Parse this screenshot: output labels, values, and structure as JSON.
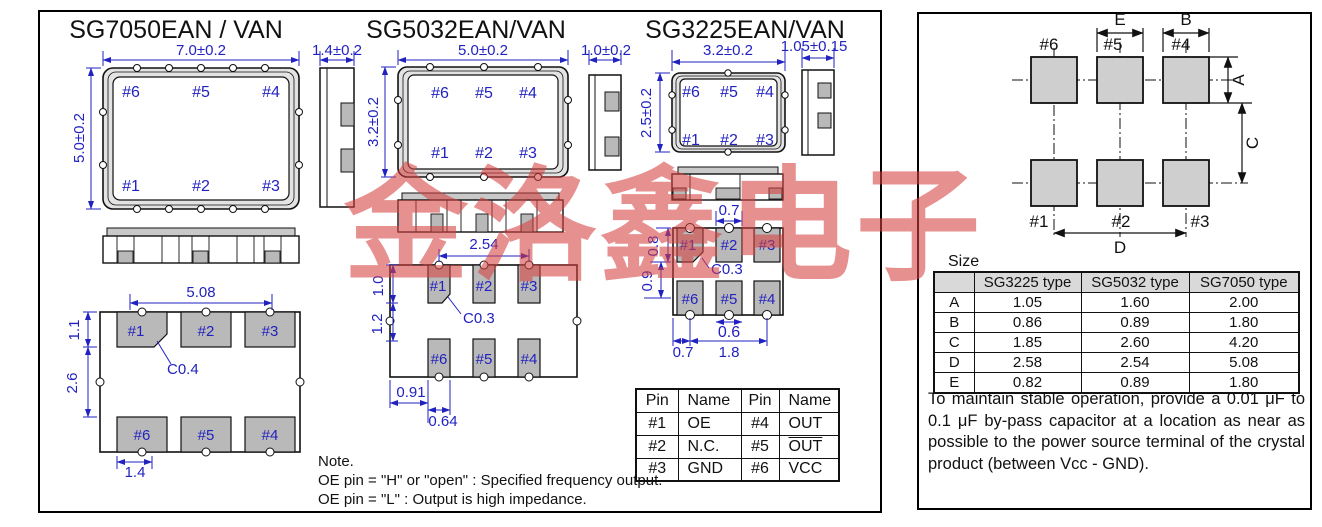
{
  "watermark": "金洛鑫电子",
  "packages": [
    {
      "title": "SG7050EAN / VAN",
      "dim_width": "7.0±0.2",
      "dim_height": "5.0±0.2",
      "dim_thickness": "1.4±0.2",
      "pins_top": [
        "#6",
        "#5",
        "#4"
      ],
      "pins_bottom": [
        "#1",
        "#2",
        "#3"
      ],
      "land": {
        "pitch": "5.08",
        "left_upper": "1.1",
        "left_lower": "2.6",
        "pad_width": "1.4",
        "chamfer": "C0.4",
        "pads_top": [
          "#1",
          "#2",
          "#3"
        ],
        "pads_bottom": [
          "#6",
          "#5",
          "#4"
        ]
      }
    },
    {
      "title": "SG5032EAN/VAN",
      "dim_width": "5.0±0.2",
      "dim_height": "3.2±0.2",
      "dim_thickness": "1.0±0.2",
      "pins_top": [
        "#6",
        "#5",
        "#4"
      ],
      "pins_bottom": [
        "#1",
        "#2",
        "#3"
      ],
      "land": {
        "pitch": "2.54",
        "left_upper": "1.0",
        "left_lower": "1.2",
        "offset": "0.91",
        "pad_width": "0.64",
        "chamfer": "C0.3",
        "pads_top": [
          "#1",
          "#2",
          "#3"
        ],
        "pads_bottom": [
          "#6",
          "#5",
          "#4"
        ]
      }
    },
    {
      "title": "SG3225EAN/VAN",
      "dim_width": "3.2±0.2",
      "dim_height": "2.5±0.2",
      "dim_thickness": "1.05±0.15",
      "pins_top": [
        "#6",
        "#5",
        "#4"
      ],
      "pins_bottom": [
        "#1",
        "#2",
        "#3"
      ],
      "land": {
        "top": "0.7",
        "left_upper": "0.8",
        "left_lower": "0.9",
        "notch": "0.6",
        "bottom_left": "0.7",
        "bottom_right": "1.8",
        "chamfer": "C0.3",
        "pads_top": [
          "#1",
          "#2",
          "#3"
        ],
        "pads_bottom": [
          "#6",
          "#5",
          "#4"
        ]
      }
    }
  ],
  "pin_table": {
    "headers": [
      "Pin",
      "Name",
      "Pin",
      "Name"
    ],
    "rows": [
      [
        "#1",
        "OE",
        "#4",
        "OUT"
      ],
      [
        "#2",
        "N.C.",
        "#5",
        "OUT"
      ],
      [
        "#3",
        "GND",
        "#6",
        "VCC"
      ]
    ]
  },
  "note": {
    "title": "Note.",
    "line1": "OE pin = \"H\" or \"open\" : Specified frequency output.",
    "line2": "OE pin = \"L\" : Output is high impedance."
  },
  "pad_layout": {
    "pins_top": [
      "#6",
      "#5",
      "#4"
    ],
    "pins_bottom": [
      "#1",
      "#2",
      "#3"
    ],
    "dim_e": "E",
    "dim_b": "B",
    "dim_a": "A",
    "dim_c": "C",
    "dim_d": "D"
  },
  "size_table": {
    "caption": "Size",
    "headers": [
      "",
      "SG3225 type",
      "SG5032 type",
      "SG7050 type"
    ],
    "rows": [
      [
        "A",
        "1.05",
        "1.60",
        "2.00"
      ],
      [
        "B",
        "0.86",
        "0.89",
        "1.80"
      ],
      [
        "C",
        "1.85",
        "2.60",
        "4.20"
      ],
      [
        "D",
        "2.58",
        "2.54",
        "5.08"
      ],
      [
        "E",
        "0.82",
        "0.89",
        "1.80"
      ]
    ]
  },
  "bypass_note": "To maintain stable operation, provide a 0.01 μF to 0.1 μF by-pass capacitor at a location as near as possible to the power source terminal of the crystal product (between Vcc - GND).",
  "colors": {
    "dimension_blue": "#2222c0",
    "pad_gray": "#b9b9b9",
    "ring_gray": "#e3e3e3",
    "watermark_red": "#d64040",
    "table_header_gray": "#d9d9d9"
  }
}
